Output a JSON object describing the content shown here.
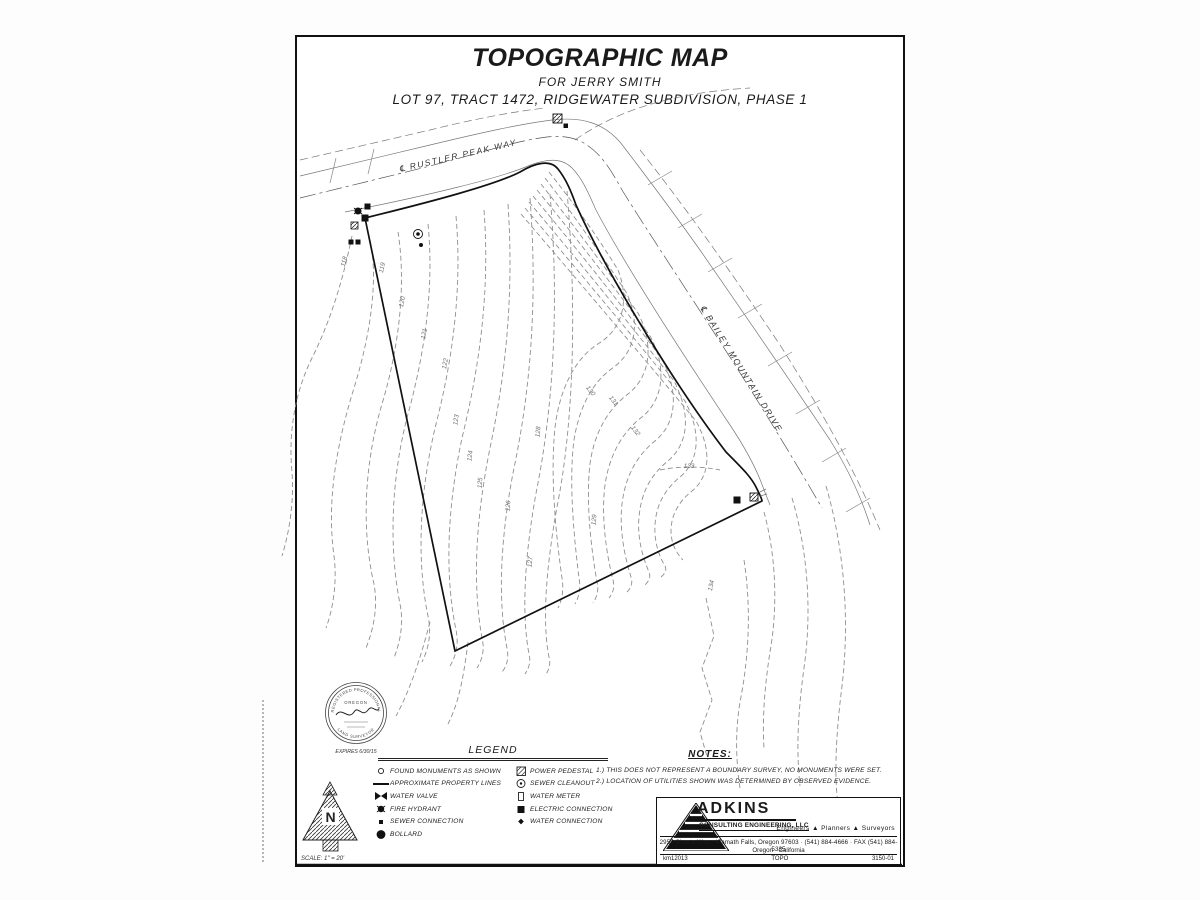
{
  "sheet": {
    "title": "TOPOGRAPHIC MAP",
    "subtitle": "FOR JERRY SMITH",
    "description": "LOT 97, TRACT 1472, RIDGEWATER SUBDIVISION, PHASE 1"
  },
  "map": {
    "streets": {
      "rustler_peak_way": "℄ RUSTLER PEAK WAY",
      "bailey_mountain_drive": "℄ BAILEY MOUNTAIN DRIVE"
    },
    "contour_labels": [
      "118",
      "119",
      "120",
      "121",
      "122",
      "123",
      "124",
      "125",
      "126",
      "127",
      "128",
      "129",
      "130",
      "131",
      "132",
      "133",
      "134"
    ]
  },
  "stamp": {
    "arc_top": "REGISTERED PROFESSIONAL",
    "arc_bottom": "LAND SURVEYOR",
    "state": "OREGON",
    "expires": "EXPIRES 6/30/15"
  },
  "north_arrow": {
    "letter": "N",
    "scale": "SCALE: 1\" = 20'"
  },
  "legend": {
    "title": "LEGEND",
    "left_items": [
      {
        "label": "FOUND MONUMENTS AS SHOWN"
      },
      {
        "label": "APPROXIMATE PROPERTY LINES"
      },
      {
        "label": "WATER VALVE"
      },
      {
        "label": "FIRE HYDRANT"
      },
      {
        "label": "SEWER CONNECTION"
      },
      {
        "label": "BOLLARD"
      }
    ],
    "right_items": [
      {
        "label": "POWER PEDESTAL"
      },
      {
        "label": "SEWER CLEANOUT"
      },
      {
        "label": "WATER METER"
      },
      {
        "label": "ELECTRIC CONNECTION"
      },
      {
        "label": "WATER CONNECTION"
      }
    ]
  },
  "notes": {
    "title": "NOTES:",
    "items": [
      "1.) THIS DOES NOT REPRESENT A BOUNDARY SURVEY, NO MONUMENTS WERE SET.",
      "2.) LOCATION OF UTILITIES SHOWN WAS DETERMINED BY OBSERVED EVIDENCE."
    ]
  },
  "firm": {
    "name": "ADKINS",
    "subname": "CONSULTING ENGINEERING, LLC",
    "disciplines": "Engineers   ▲   Planners   ▲   Surveyors",
    "address": "2950 Shasta Way · Klamath Falls, Oregon 97603 · (541) 884-4666 · FAX (541) 884-5335",
    "states": "Oregon · California",
    "job_left": "km12013",
    "job_center": "TOPO",
    "job_right": "3150-01"
  }
}
